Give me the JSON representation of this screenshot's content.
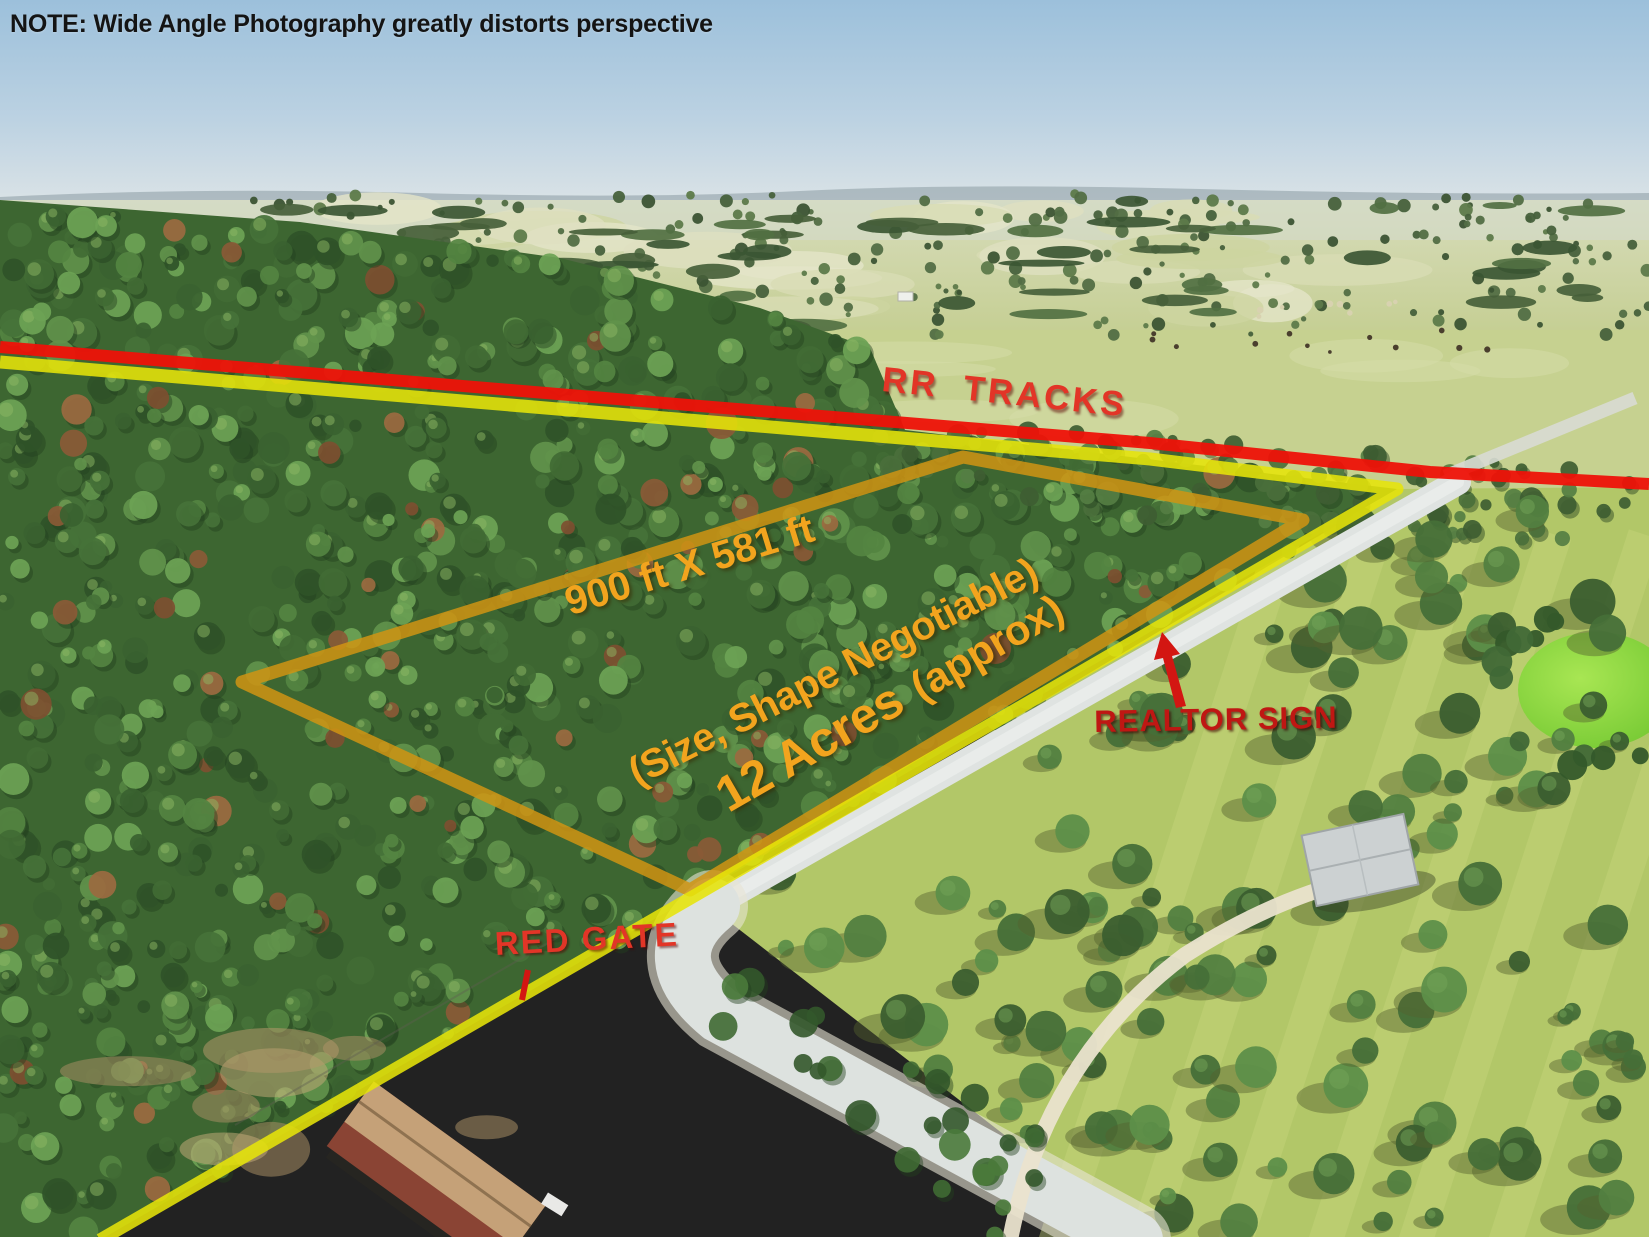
{
  "image_type": "aerial-property-listing-photo",
  "annotations": {
    "note": "NOTE: Wide Angle Photography greatly distorts perspective",
    "rr_tracks": "RR  TRACKS",
    "dimensions": "900 ft X 581 ft",
    "size_shape": "(Size, Shape Negotiable)",
    "acres": "12 Acres",
    "acres_qualifier": "(approx)",
    "realtor_sign": "REALTOR SIGN",
    "red_gate": "RED GATE"
  },
  "colors": {
    "rr_tracks_line": "#ee1208",
    "road_frontage_line": "#e6e409",
    "property_boundary": "#d09413",
    "orange_text": "#f2a41e",
    "red_label": "#e23527",
    "dark_red_label": "#bf1713",
    "note_text": "#141414",
    "arrow_red": "#d31612"
  },
  "icons": {
    "realtor_sign_arrow": "red-arrow-pointing-up-to-road",
    "red_gate_marker": "red-tick-below-label"
  }
}
